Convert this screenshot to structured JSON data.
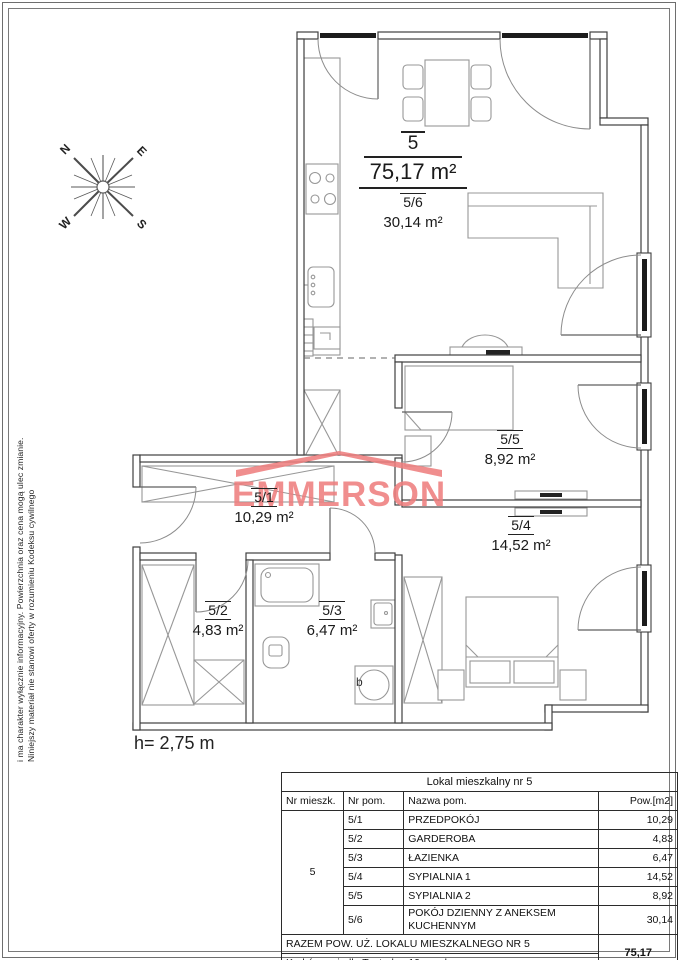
{
  "sheet": {
    "disclaimer": {
      "line1": "Niniejszy materiał nie stanowi oferty w rozumieniu Kodeksu cywilnego",
      "line2": "i ma charakter wyłącznie informacyjny. Powierzchnia oraz cena mogą ulec zmianie."
    },
    "height_note": "h= 2,75 m",
    "compass": {
      "n": "N",
      "e": "E",
      "w": "W",
      "s": "S"
    }
  },
  "logo": {
    "text": "EMMERSON",
    "color": "#ee7f7f"
  },
  "plan": {
    "apartment": {
      "number": "5",
      "area": "75,17 m²"
    },
    "rooms": {
      "r56": {
        "id": "5/6",
        "area": "30,14 m²"
      },
      "r51": {
        "id": "5/1",
        "area": "10,29 m²"
      },
      "r52": {
        "id": "5/2",
        "area": "4,83 m²"
      },
      "r53": {
        "id": "5/3",
        "area": "6,47 m²"
      },
      "r54": {
        "id": "5/4",
        "area": "14,52 m²"
      },
      "r55": {
        "id": "5/5",
        "area": "8,92 m²"
      }
    },
    "bath_mark": "b"
  },
  "table": {
    "title": "Lokal mieszkalny nr 5",
    "columns": [
      "Nr mieszk.",
      "Nr pom.",
      "Nazwa pom.",
      "Pow.[m2]"
    ],
    "apartment_no": "5",
    "rows": [
      {
        "no": "5/1",
        "name": "PRZEDPOKÓJ",
        "area": "10,29"
      },
      {
        "no": "5/2",
        "name": "GARDEROBA",
        "area": "4,83"
      },
      {
        "no": "5/3",
        "name": "ŁAZIENKA",
        "area": "6,47"
      },
      {
        "no": "5/4",
        "name": "SYPIALNIA 1",
        "area": "14,52"
      },
      {
        "no": "5/5",
        "name": "SYPIALNIA 2",
        "area": "8,92"
      },
      {
        "no": "5/6",
        "name": "POKÓJ DZIENNY Z ANEKSEM KUCHENNYM",
        "area": "30,14"
      }
    ],
    "total_label": "RAZEM POW. UŻ. LOKALU MIESZKALNEGO NR 5",
    "total_area": "75,17",
    "address": "Kraków, osiedle Teatralne 19 nr adresowy"
  }
}
